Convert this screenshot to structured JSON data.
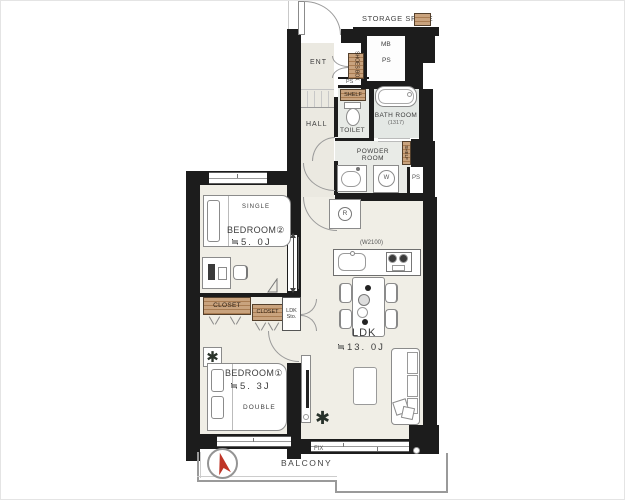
{
  "labels": {
    "storage_space": "STORAGE SPACE",
    "mb": "MB",
    "ps": "PS",
    "ent": "ENT",
    "shoes_box": "SHOES BOX",
    "shelf": "SHELF",
    "hall": "HALL",
    "toilet": "TOILET",
    "bath_room": "BATH ROOM",
    "bath_size": "(1317)",
    "powder_line1": "POWDER",
    "powder_line2": "ROOM",
    "fix": "FIX",
    "balcony": "BALCONY",
    "fridge": "R",
    "washer": "W",
    "closet": "CLOSET",
    "ldk_sto_line1": "LDK",
    "ldk_sto_line2": "Sto.",
    "single": "SINGLE",
    "double": "DOUBLE"
  },
  "rooms": {
    "bedroom2": {
      "name": "BEDROOM②",
      "size": "≒5. 0J"
    },
    "bedroom1": {
      "name": "BEDROOM①",
      "size": "≒5. 3J"
    },
    "ldk": {
      "name": "LDK",
      "size": "≒13. 0J",
      "kitchen_width": "(W2100)"
    }
  },
  "colors": {
    "wall": "#1c1c1c",
    "floor": "#f0eee6",
    "wet_floor": "#e7eae6",
    "hall_floor": "#ebe9e1",
    "storage_tan": "#c9a37e",
    "storage_tan_stripe": "#a97c52",
    "compass_red": "#bf3527",
    "outline_gray": "#8b8b8b"
  }
}
